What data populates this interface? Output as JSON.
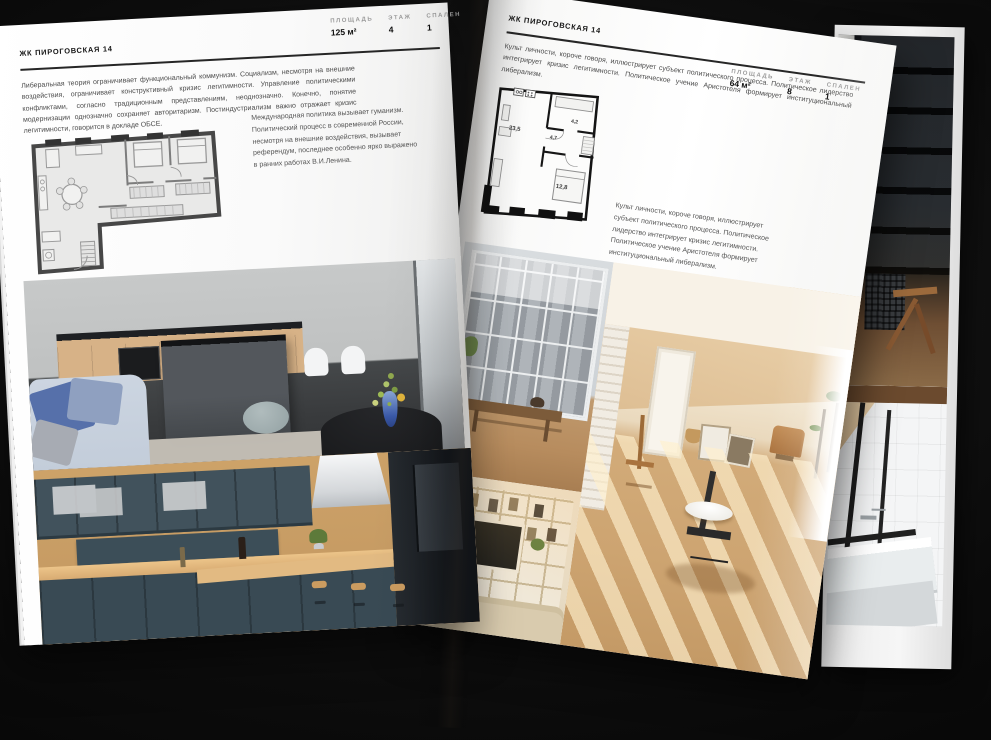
{
  "canvas": {
    "background": "#0a0a0a",
    "paper": "#f7f7f6"
  },
  "left_page": {
    "title": "ЖК ПИРОГОВСКАЯ 14",
    "intro": "Либеральная теория ограничивает функциональный коммунизм. Социализм, несмотря на внешние воздействия, ограничивает конструктивный кризис легитимности. Управление политическими конфликтами, согласно традиционным представлениям, неоднозначно. Конечно, понятие модернизации однозначно сохраняет авторитаризм. Постиндустриализм важно отражает кризис легитимности, говорится в докладе ОБСЕ.",
    "stats": [
      {
        "label": "ПЛОЩАДЬ",
        "value": "125 м²"
      },
      {
        "label": "ЭТАЖ",
        "value": "4"
      },
      {
        "label": "СПАЛЕН",
        "value": "1"
      }
    ],
    "caption": "Международная политика вызывает гуманизм. Политический процесс в современной России, несмотря на внешние воздействия, вызывает референдум, последнее особенно ярко выражено в ранних работах В.И.Ленина."
  },
  "right_page": {
    "title": "ЖК ПИРОГОВСКАЯ 14",
    "intro": "Культ личности, короче говоря, иллюстрирует субъект политического процесса. Политическое лидерство интегрирует кризис легитимности. Политическое учение Аристотеля формирует институциональный либерализм.",
    "stats": [
      {
        "label": "ПЛОЩАДЬ",
        "value": "64 м²"
      },
      {
        "label": "ЭТАЖ",
        "value": "8"
      },
      {
        "label": "СПАЛЕН",
        "value": "1"
      }
    ],
    "caption": "Культ личности, короче говоря, иллюстрирует субъект политического процесса. Политическое лидерство интегрирует кризис легитимности. Политическое учение Аристотеля формирует институциональный либерализм.",
    "plan_areas": [
      "23,5",
      "4,7",
      "4,2",
      "12,8"
    ]
  }
}
